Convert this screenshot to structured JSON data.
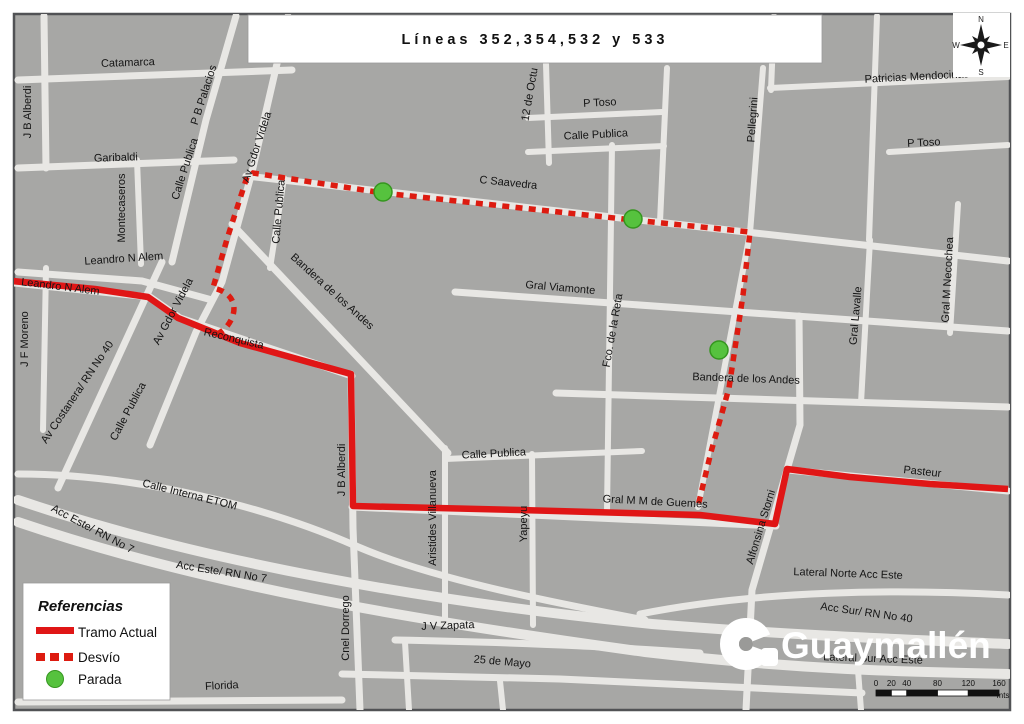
{
  "title": {
    "text": "Líneas 352,354,532 y 533"
  },
  "compass": {
    "n": "N",
    "e": "E",
    "s": "S",
    "w": "W"
  },
  "legend": {
    "title": "Referencias",
    "items": [
      {
        "symbol": "solid-line",
        "label": "Tramo Actual"
      },
      {
        "symbol": "dashed-line",
        "label": "Desvío"
      },
      {
        "symbol": "green-dot",
        "label": "Parada"
      }
    ]
  },
  "logo": {
    "text": "Guaymallén"
  },
  "scalebar": {
    "ticks": [
      "0",
      "20",
      "40",
      "80",
      "120",
      "160"
    ],
    "unit": "mts"
  },
  "colors": {
    "route_solid": "#e01616",
    "route_dashed": "#dd1b10",
    "stop_fill": "#56c23e",
    "stop_stroke": "#35961f",
    "land": "#a7a7a5",
    "street": "#e8e7e4",
    "frame": "#515255"
  },
  "map": {
    "street_labels": [
      {
        "t": "Catamarca",
        "x": 128,
        "y": 66,
        "r": -2
      },
      {
        "t": "J B Alberdi",
        "x": 31,
        "y": 112,
        "r": -90
      },
      {
        "t": "Garibaldi",
        "x": 116,
        "y": 161,
        "r": -2
      },
      {
        "t": "Montecaseros",
        "x": 125,
        "y": 208,
        "r": -90
      },
      {
        "t": "P B Palacios",
        "x": 207,
        "y": 96,
        "r": -72
      },
      {
        "t": "Calle Publica",
        "x": 188,
        "y": 170,
        "r": -72
      },
      {
        "t": "Av Gdor Videla",
        "x": 260,
        "y": 148,
        "r": -72
      },
      {
        "t": "Calle Publica",
        "x": 282,
        "y": 212,
        "r": -85
      },
      {
        "t": "12 de Octu",
        "x": 533,
        "y": 95,
        "r": -80
      },
      {
        "t": "P Toso",
        "x": 600,
        "y": 106,
        "r": -3
      },
      {
        "t": "Calle Publica",
        "x": 596,
        "y": 138,
        "r": -3
      },
      {
        "t": "Pellegrini",
        "x": 756,
        "y": 120,
        "r": -86
      },
      {
        "t": "Patricias Mendocinas",
        "x": 917,
        "y": 80,
        "r": -3
      },
      {
        "t": "P Toso",
        "x": 924,
        "y": 146,
        "r": -3
      },
      {
        "t": "C Saavedra",
        "x": 508,
        "y": 186,
        "r": 6
      },
      {
        "t": "Gral Viamonte",
        "x": 560,
        "y": 291,
        "r": 5
      },
      {
        "t": "Fco. de la Reta",
        "x": 616,
        "y": 331,
        "r": -80
      },
      {
        "t": "Gral Lavalle",
        "x": 859,
        "y": 316,
        "r": -85
      },
      {
        "t": "Gral M Necochea",
        "x": 951,
        "y": 280,
        "r": -87
      },
      {
        "t": "Leandro N Alem",
        "x": 124,
        "y": 262,
        "r": -4
      },
      {
        "t": "Leandro N Alem",
        "x": 60,
        "y": 290,
        "r": 7
      },
      {
        "t": "J F Moreno",
        "x": 28,
        "y": 339,
        "r": -90
      },
      {
        "t": "Av Costanera/ RN No 40",
        "x": 80,
        "y": 394,
        "r": -56
      },
      {
        "t": "Calle Publica",
        "x": 131,
        "y": 413,
        "r": -62
      },
      {
        "t": "Av Gdor Videla",
        "x": 176,
        "y": 313,
        "r": -62
      },
      {
        "t": "Reconquista",
        "x": 233,
        "y": 342,
        "r": 13
      },
      {
        "t": "Bandera de los Andes",
        "x": 330,
        "y": 294,
        "r": 42
      },
      {
        "t": "Bandera de los Andes",
        "x": 746,
        "y": 382,
        "r": 2
      },
      {
        "t": "Calle Publica",
        "x": 494,
        "y": 457,
        "r": -3
      },
      {
        "t": "J B Alberdi",
        "x": 345,
        "y": 470,
        "r": -90
      },
      {
        "t": "Aristides Villanueva",
        "x": 436,
        "y": 518,
        "r": -90
      },
      {
        "t": "Yapeyu",
        "x": 527,
        "y": 524,
        "r": -90
      },
      {
        "t": "Calle Interna ETOM",
        "x": 189,
        "y": 498,
        "r": 14
      },
      {
        "t": "Acc Este/ RN No 7",
        "x": 91,
        "y": 532,
        "r": 28
      },
      {
        "t": "Acc Este/ RN No 7",
        "x": 221,
        "y": 575,
        "r": 9
      },
      {
        "t": "Gral M M de Guemes",
        "x": 655,
        "y": 505,
        "r": 3
      },
      {
        "t": "Alfonsina Storni",
        "x": 764,
        "y": 528,
        "r": -73
      },
      {
        "t": "Pasteur",
        "x": 922,
        "y": 475,
        "r": 6
      },
      {
        "t": "Cnel Dorrego",
        "x": 349,
        "y": 628,
        "r": -90
      },
      {
        "t": "J V Zapata",
        "x": 448,
        "y": 629,
        "r": -2
      },
      {
        "t": "25 de Mayo",
        "x": 502,
        "y": 665,
        "r": 5
      },
      {
        "t": "Florida",
        "x": 222,
        "y": 689,
        "r": -3
      },
      {
        "t": "Lateral Norte Acc Este",
        "x": 848,
        "y": 577,
        "r": 2
      },
      {
        "t": "Acc Sur/ RN No 40",
        "x": 866,
        "y": 616,
        "r": 8
      },
      {
        "t": "Lateral Sur Acc Este",
        "x": 873,
        "y": 662,
        "r": 2
      }
    ],
    "routes": {
      "solid": {
        "name": "Tramo Actual",
        "points": "12,281 95,289 148,297 178,318 240,343 351,374 352,440 353,506 520,510 700,515 775,524 787,469 850,477 930,484 1008,489"
      },
      "dashed": {
        "name": "Desvío",
        "path": "M217,334 C222,332 228,327 232,318 C237,306 233,292 213,288 L227,239 L247,177 L253,173 L383,193 L512,207 L633,220 L750,232 L743,295 L729,388 L711,452 L698,506"
      }
    },
    "stops": [
      {
        "name": "Parada",
        "x": 383,
        "y": 192
      },
      {
        "name": "Parada",
        "x": 633,
        "y": 219
      },
      {
        "name": "Parada",
        "x": 719,
        "y": 350
      }
    ]
  }
}
